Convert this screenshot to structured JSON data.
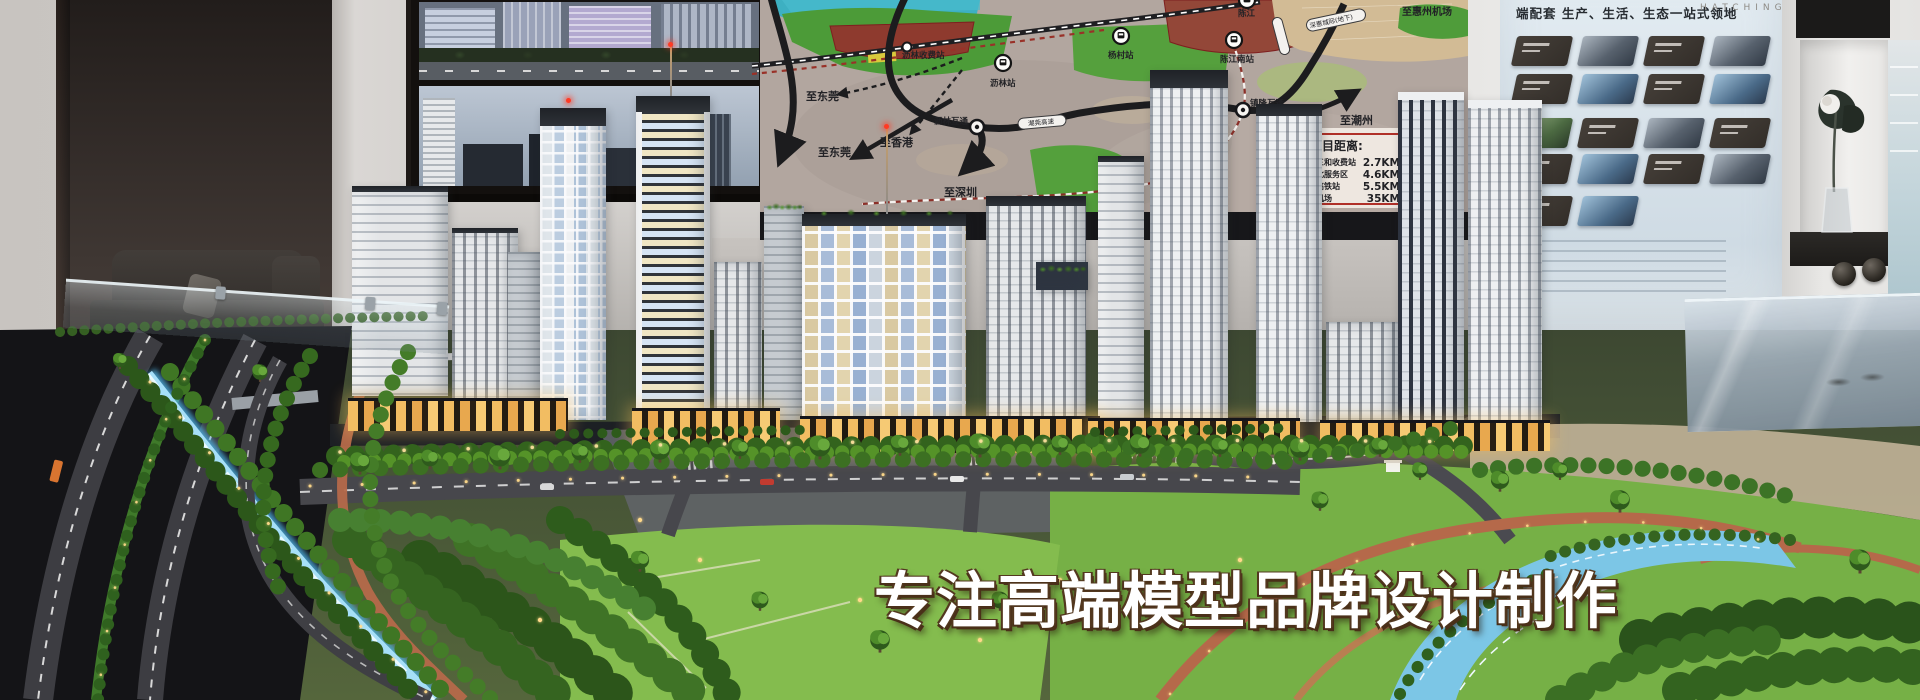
{
  "caption": "专注高端模型品牌设计制作",
  "map": {
    "destinations": [
      {
        "label": "至东莞"
      },
      {
        "label": "至东莞"
      },
      {
        "label": "至香港"
      },
      {
        "label": "至深圳"
      },
      {
        "label": "至潮州"
      },
      {
        "label": "至惠州机场"
      }
    ],
    "stations": [
      {
        "name": "沥林收费站"
      },
      {
        "name": "沥林站"
      },
      {
        "name": "杨村站"
      },
      {
        "name": "陈江"
      },
      {
        "name": "陈江南站"
      },
      {
        "name": "沥林互通"
      },
      {
        "name": "镇隆互通"
      }
    ],
    "rail_label": "深惠城际(地下)",
    "highway_label": "潮莞高速",
    "distance_panel": {
      "title": "目距离:",
      "rows": [
        {
          "name": "三和收费站",
          "value": "2.7KM"
        },
        {
          "name": "北服务区",
          "value": "4.6KM"
        },
        {
          "name": "高铁站",
          "value": "5.5KM"
        },
        {
          "name": "机场",
          "value": "35KM"
        }
      ]
    }
  },
  "right_board": {
    "brand": "HATCHING",
    "header": "端配套 生产、生活、生态一站式领地"
  }
}
